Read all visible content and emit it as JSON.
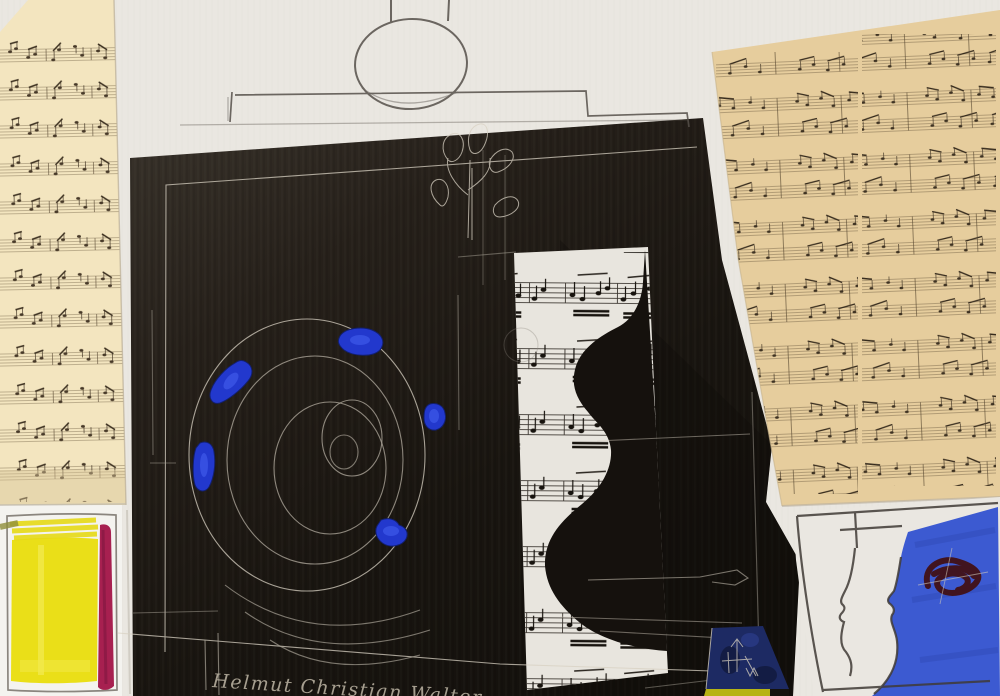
{
  "artwork": {
    "description": "Photograph of a mixed-media collage: a dark charcoal panel with a scratched spiral, blue paint daubs and a vase silhouette over pasted sheet-music pages, flanked by aged music scores, a yellow painted square with a crimson stripe, and two drawn profile faces on blue",
    "signature": "Helmut Christian Walter",
    "palette": {
      "cream_sheet": "#f3e5bf",
      "tan_sheet": "#e6cd9d",
      "paper_white": "#eae7e1",
      "bright_white": "#f4f3ef",
      "panel_black": "#1c1712",
      "ultramarine": "#2238cd",
      "ultramarine_light": "#3b55e6",
      "yellow": "#eadf18",
      "crimson": "#a72050",
      "face_blue": "#3c5ad1",
      "maroon": "#421116",
      "dark_navy": "#1d2a63",
      "olive": "#b6b315",
      "scratch": "#d8d1c3",
      "pencil": "#56504a",
      "charcoal_line": "#403b36",
      "note_ink": "#473928",
      "strip_white": "#e8e5de"
    }
  }
}
